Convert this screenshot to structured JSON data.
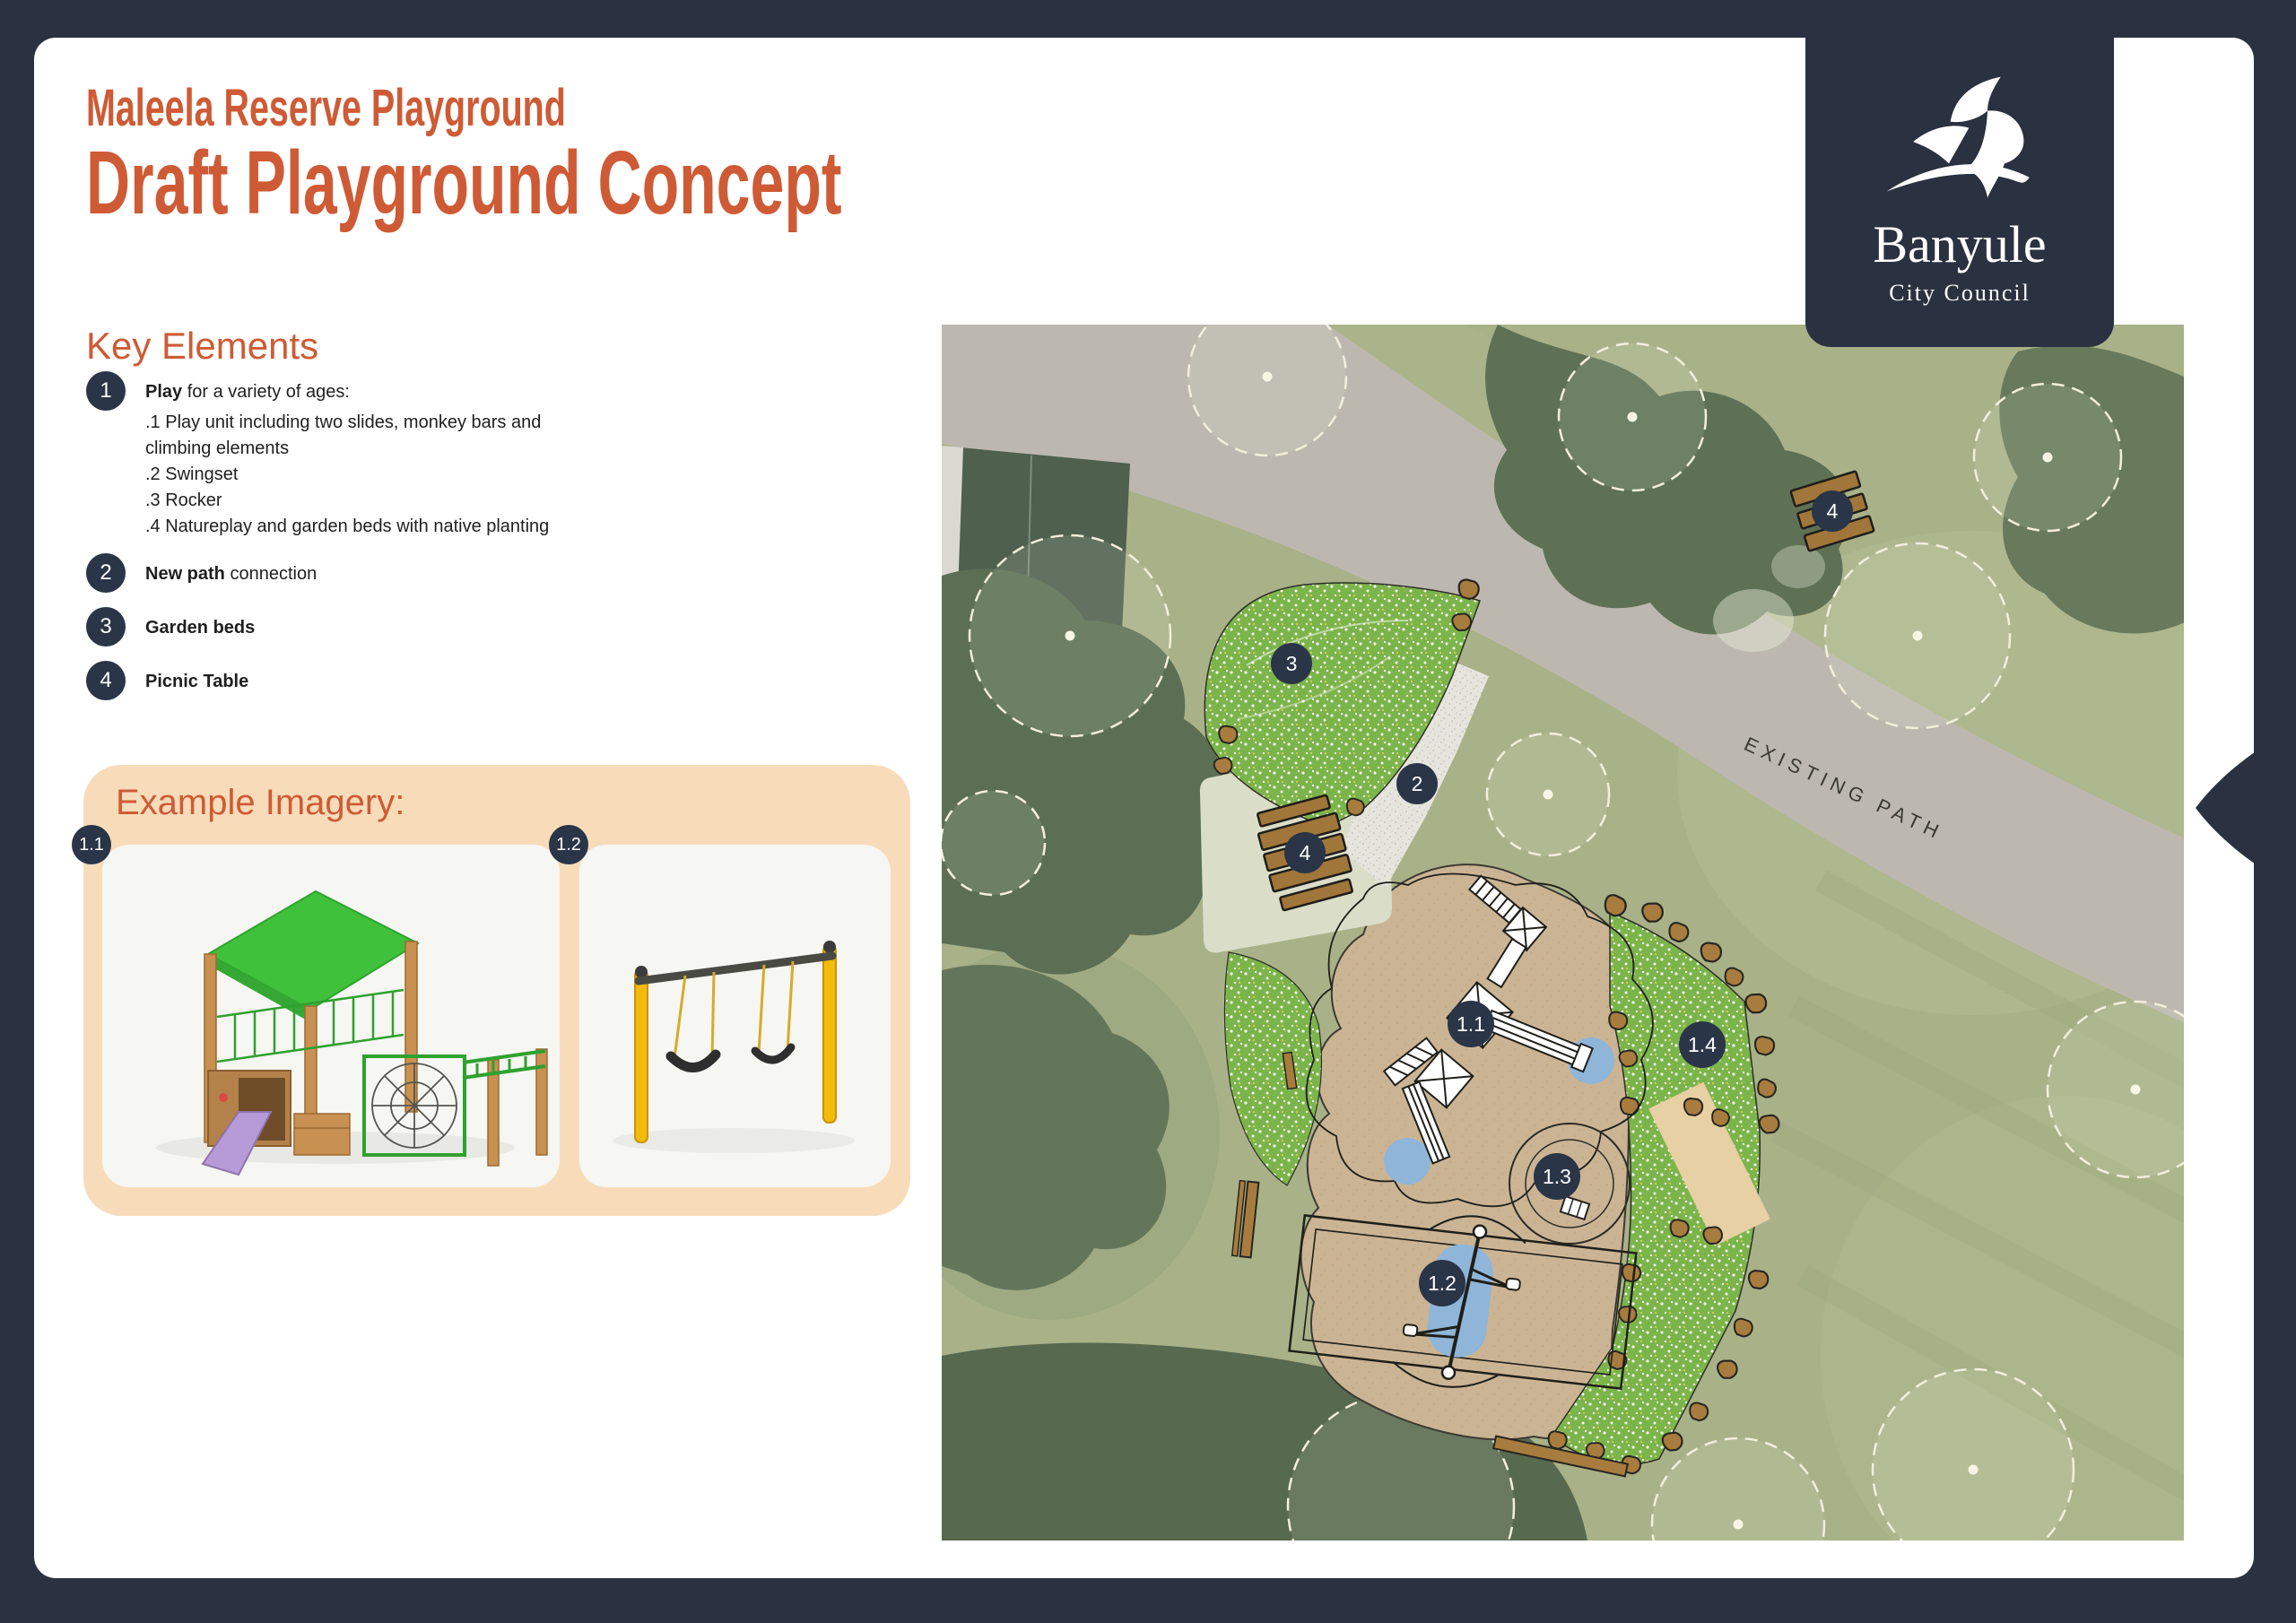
{
  "page": {
    "title_line1": "Maleela Reserve Playground",
    "title_line2": "Draft Playground Concept"
  },
  "logo": {
    "name": "Banyule",
    "subtitle": "City Council"
  },
  "key_elements": {
    "heading": "Key Elements",
    "items": [
      {
        "number": "1",
        "bold": "Play",
        "rest": " for a variety of ages:",
        "sub": [
          ".1 Play unit including two slides, monkey bars and",
          "climbing elements",
          ".2 Swingset",
          ".3 Rocker",
          ".4 Natureplay and garden beds with native planting"
        ]
      },
      {
        "number": "2",
        "bold": "New path",
        "rest": " connection"
      },
      {
        "number": "3",
        "bold": "Garden beds",
        "rest": ""
      },
      {
        "number": "4",
        "bold": "Picnic Table",
        "rest": ""
      }
    ]
  },
  "example_imagery": {
    "heading": "Example Imagery:",
    "cards": [
      {
        "badge": "1.1"
      },
      {
        "badge": "1.2"
      }
    ]
  },
  "map": {
    "existing_path_label": "EXISTING PATH",
    "badges": {
      "picnic_top": "4",
      "garden_bed": "3",
      "new_path": "2",
      "picnic_pad": "4",
      "play_unit": "1.1",
      "natureplay": "1.4",
      "rocker": "1.3",
      "swingset": "1.2"
    }
  },
  "colors": {
    "accent_orange": "#CE5B35",
    "frame_navy": "#2A3140",
    "badge_navy": "#2A3547",
    "panel_peach": "#F8DCBA",
    "map_grass": "#A9B188",
    "playground_tan": "#CBB494",
    "garden_green": "#7CB44C",
    "softfall_blue": "#8FB5D9",
    "rock_brown": "#A87C3F"
  }
}
